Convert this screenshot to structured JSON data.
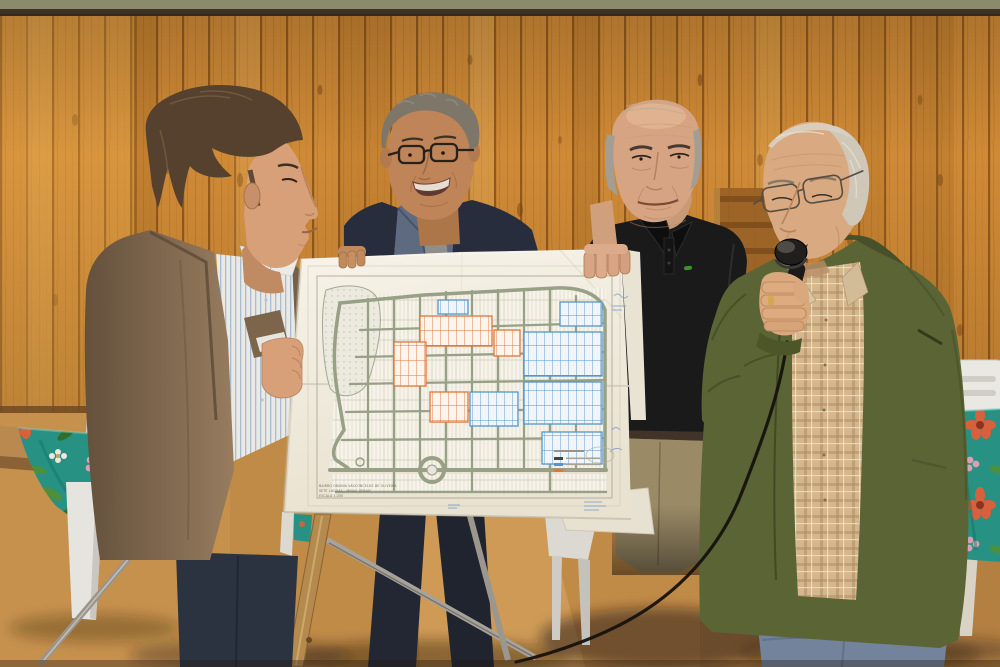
{
  "meta": {
    "alt": "Four men hold up a large printed street plan of a neighbourhood in a wood-panelled hall while an elderly man in an olive jacket speaks into a microphone."
  },
  "map_document": {
    "type": "urban subdivision plan on white paper",
    "title_lines": [
      "BAIRRO ONDINA VASCONCELOS DE OLIVEIRA",
      "SETE LAGOAS - MINAS GERAIS",
      "ESCALA 1:200"
    ],
    "paper_color": "#f3efe5",
    "road_color": "#98a086",
    "highlight_orange": "#e0763a",
    "highlight_blue": "#5596c8",
    "annotation_ink": "#7fa0cc",
    "legend_swatches": [
      "#44443a",
      "#5596c8",
      "#e0763a"
    ]
  },
  "scene": {
    "palette": {
      "wood_wall": "#cf8a36",
      "top_beam": "#8b8a6d",
      "floor": "#c08a47",
      "tablecloth_teal": "#279184",
      "chair_white": "#e9e8e3",
      "easel_wood": "#b58a4e"
    },
    "people": [
      {
        "id": "man-1",
        "position": "far left",
        "appearance": "brown blazer, blue striped shirt, dark hair",
        "action": "grips left edge of the map"
      },
      {
        "id": "man-2",
        "position": "centre left",
        "appearance": "navy blazer, glasses, grey curly hair, smiling",
        "action": "holds top edge of the map"
      },
      {
        "id": "man-3",
        "position": "centre right",
        "appearance": "black polo shirt, balding, khaki trousers",
        "action": "holds top right of the map"
      },
      {
        "id": "man-4",
        "position": "far right",
        "appearance": "olive green jacket, tan plaid shirt, wire glasses, jeans",
        "action": "speaks into a microphone"
      }
    ],
    "objects": [
      "wooden easel with metal braces",
      "black microphone with cable",
      "two tables with teal floral tablecloths",
      "white plastic chairs",
      "sheet of paper on right table"
    ]
  }
}
